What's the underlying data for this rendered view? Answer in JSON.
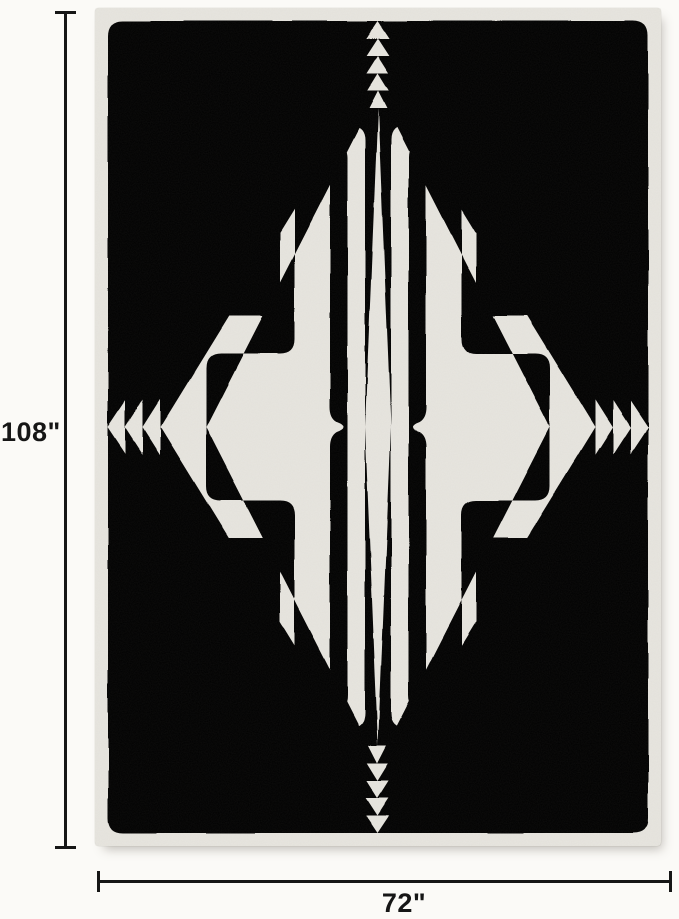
{
  "image_type": "product dimension diagram",
  "subject": {
    "name": "labyrinth maze pattern area rug",
    "pattern": "concentric meander labyrinth lines, mirrored in four quadrants",
    "orientation": "vertical rectangle"
  },
  "dimensions": {
    "height": {
      "label": "108\""
    },
    "width": {
      "label": "72\""
    }
  },
  "colors": {
    "page_bg": "#fbfaf7",
    "rug_base": "#e8e6e0",
    "pattern_line": "#5f564a",
    "dim_color": "#161616"
  }
}
